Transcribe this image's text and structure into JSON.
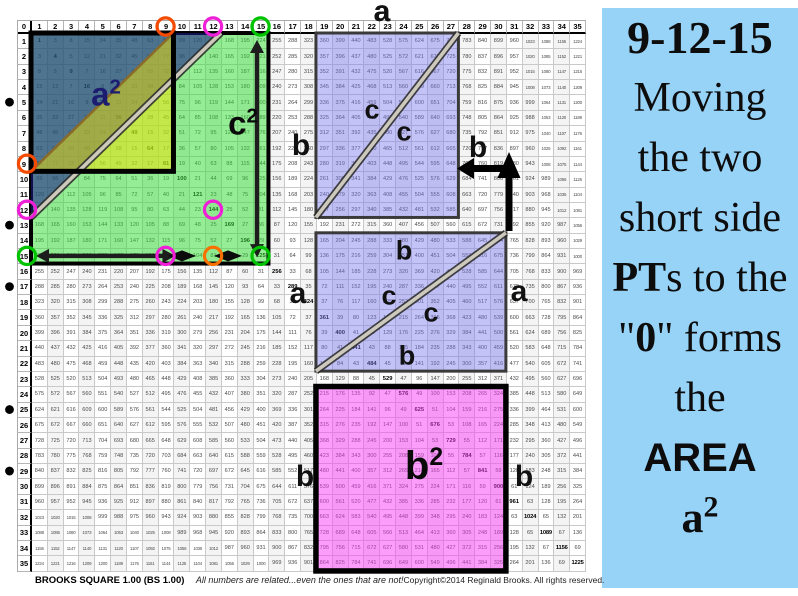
{
  "top_label": "a",
  "grid": {
    "axis_min": 0,
    "axis_max": 35,
    "axis_corner": "0",
    "value_rule": "cell(r,c) = (r==c) ? r*r : abs(r*r - c*c); axis row and column show 0-35; diagonal squares are bold",
    "pt_hypotenuse_dot_rows": [
      5,
      13,
      17,
      25,
      29
    ],
    "circled_triple": [
      9,
      12,
      15
    ]
  },
  "circles": [
    {
      "kind": "col-header",
      "n": 9,
      "color": "#f54a00"
    },
    {
      "kind": "col-header",
      "n": 12,
      "color": "#ee1fd6"
    },
    {
      "kind": "col-header",
      "n": 15,
      "color": "#00c300"
    },
    {
      "kind": "row-header",
      "n": 9,
      "color": "#f54a00"
    },
    {
      "kind": "row-header",
      "n": 12,
      "color": "#ee1fd6"
    },
    {
      "kind": "row-header",
      "n": 15,
      "color": "#00c300"
    },
    {
      "kind": "cell",
      "row": 12,
      "col": 12,
      "color": "#ee1fd6"
    },
    {
      "kind": "cell",
      "row": 15,
      "col": 9,
      "color": "#ee1fd6"
    },
    {
      "kind": "cell",
      "row": 15,
      "col": 12,
      "color": "#f77000"
    },
    {
      "kind": "cell",
      "row": 15,
      "col": 15,
      "color": "#00c300"
    }
  ],
  "shapes": {
    "c2_square": {
      "cols": [
        1,
        15
      ],
      "rows": [
        1,
        15
      ],
      "fill": "rgba(52,222,52,0.52)",
      "stroke": "#000000",
      "sw": 4
    },
    "a2_square": {
      "cols": [
        1,
        9
      ],
      "rows": [
        1,
        9
      ],
      "fill": "none",
      "stroke": "#000000",
      "sw": 5
    },
    "navy_triangle": {
      "legs_cells": 12,
      "fill": "rgba(28,28,140,0.58)",
      "hyp_stroke": "#2d2d2d"
    },
    "yellow_triangle": {
      "cols": [
        1,
        9
      ],
      "rows": [
        1,
        9
      ],
      "fill": "rgba(244,226,0,0.5)",
      "hyp_stroke": "#8a6b2a"
    },
    "pt_region_top": {
      "cols": [
        19,
        27
      ],
      "rows": [
        1,
        12
      ],
      "fill": "rgba(122,122,240,0.45)",
      "stroke": "#3a3a3a",
      "sw": 3
    },
    "pt_region_bottom": {
      "cols": [
        19,
        30
      ],
      "rows": [
        14,
        22
      ],
      "fill": "rgba(122,122,240,0.45)",
      "stroke": "#3a3a3a",
      "sw": 3
    },
    "b2_square": {
      "cols": [
        19,
        30
      ],
      "rows": [
        24,
        35
      ],
      "fill": "rgba(250,60,250,0.5)",
      "stroke": "#000000",
      "sw": 5.5
    }
  },
  "diagram_labels": [
    {
      "t": "a",
      "x": 382,
      "y": 12,
      "s": 30,
      "c": "#111111"
    },
    {
      "t": "a",
      "sup": "2",
      "x": 106,
      "y": 94,
      "s": 33,
      "c": "#1c1c70"
    },
    {
      "t": "c",
      "sup": "2",
      "x": 243,
      "y": 123,
      "s": 33,
      "c": "#0a0a0a"
    },
    {
      "t": "c",
      "x": 372,
      "y": 110,
      "s": 27,
      "c": "#111111"
    },
    {
      "t": "c",
      "x": 404,
      "y": 132,
      "s": 27,
      "c": "#111111"
    },
    {
      "t": "b",
      "x": 301,
      "y": 146,
      "s": 30,
      "c": "#111111"
    },
    {
      "t": "b",
      "x": 478,
      "y": 148,
      "s": 30,
      "c": "#111111"
    },
    {
      "t": "b",
      "x": 404,
      "y": 251,
      "s": 27,
      "c": "#111111"
    },
    {
      "t": "c",
      "x": 389,
      "y": 296,
      "s": 27,
      "c": "#111111"
    },
    {
      "t": "c",
      "x": 431,
      "y": 313,
      "s": 27,
      "c": "#111111"
    },
    {
      "t": "b",
      "x": 407,
      "y": 356,
      "s": 27,
      "c": "#111111"
    },
    {
      "t": "a",
      "x": 298,
      "y": 294,
      "s": 30,
      "c": "#111111"
    },
    {
      "t": "a",
      "x": 519,
      "y": 292,
      "s": 30,
      "c": "#111111"
    },
    {
      "t": "b",
      "sup": "2",
      "x": 424,
      "y": 466,
      "s": 40,
      "c": "#0a0a0a"
    },
    {
      "t": "b",
      "x": 305,
      "y": 477,
      "s": 30,
      "c": "#111111"
    },
    {
      "t": "b",
      "x": 524,
      "y": 477,
      "s": 30,
      "c": "#111111"
    }
  ],
  "footer": {
    "title": "BROOKS SQUARE 1.00 (BS 1.00)",
    "tagline": "All numbers are related...even the ones that are not!",
    "copyright": "Copyright©2014 Reginald Brooks. All rights reserved."
  },
  "sidebar": {
    "background": "#97d2f7",
    "lines": [
      {
        "size": 46,
        "segments": [
          {
            "t": "9-12-15",
            "bold": true
          }
        ]
      },
      {
        "size": 42,
        "segments": [
          {
            "t": "Moving"
          }
        ]
      },
      {
        "size": 42,
        "segments": [
          {
            "t": "the two"
          }
        ]
      },
      {
        "size": 42,
        "segments": [
          {
            "t": "short side"
          }
        ]
      },
      {
        "size": 42,
        "segments": [
          {
            "t": "PT",
            "bold": true
          },
          {
            "t": "s to the"
          }
        ]
      },
      {
        "size": 42,
        "segments": [
          {
            "t": "\""
          },
          {
            "t": "0",
            "bold": true
          },
          {
            "t": "\" forms"
          }
        ]
      },
      {
        "size": 42,
        "segments": [
          {
            "t": "the"
          }
        ]
      },
      {
        "size": 40,
        "segments": [
          {
            "t": "AREA",
            "bold": true,
            "sans": true
          }
        ]
      },
      {
        "size": 44,
        "segments": [
          {
            "t": "a",
            "bold": true,
            "sup": "2"
          }
        ]
      }
    ]
  }
}
